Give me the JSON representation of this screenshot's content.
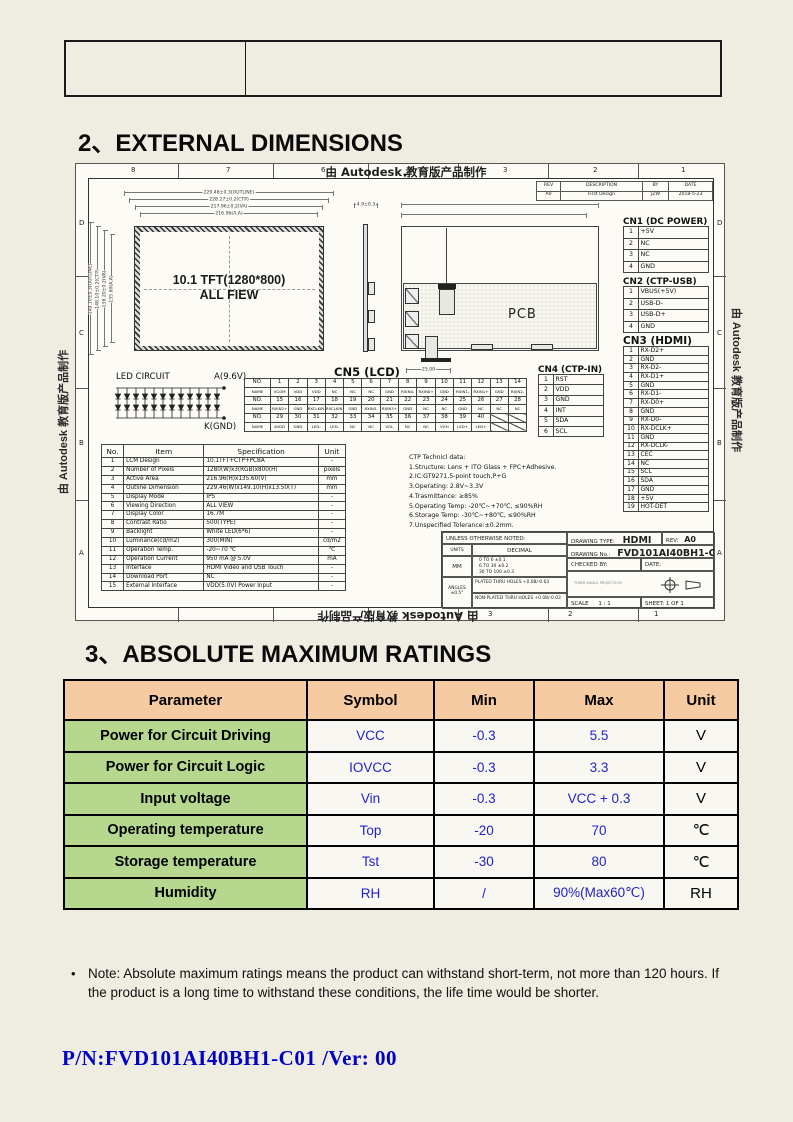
{
  "page": {
    "heading_2": "2、EXTERNAL DIMENSIONS",
    "heading_3": "3、ABSOLUTE MAXIMUM RATINGS",
    "note_bullet": "•",
    "note": "Note: Absolute maximum ratings means the product can withstand short-term, not more than 120 hours. If the product is a long time to withstand these conditions, the life time would be shorter.",
    "part_number": "P/N:FVD101AI40BH1-C01 /Ver: 00"
  },
  "drawing": {
    "watermark": "由 Autodesk 教育版产品制作",
    "watermark_arrow": "▼",
    "zones_top": [
      "8",
      "7",
      "6",
      "3",
      "2",
      "1"
    ],
    "zones_bottom": [
      "3",
      "2",
      "1"
    ],
    "zone_letters": [
      "D",
      "C",
      "B",
      "A"
    ],
    "revision": {
      "headers": [
        "REV",
        "DESCRIPTION",
        "BY",
        "DATE"
      ],
      "rows": [
        [
          "A0",
          "First Design",
          "JZW",
          "2018-5-23"
        ]
      ]
    },
    "front_view": {
      "label_line1": "10.1 TFT(1280*800)",
      "label_line2": "ALL FIEW",
      "dims_top": [
        "229.48±0.3(OUTLINE)",
        "228.27±0.2(CTP)",
        "217.96±0.2(VA)",
        "216.96(A.A)"
      ],
      "dims_left": [
        "149.10±0.3(OUTLINE)",
        "148.10±0.2(CTP)",
        "136.20±0.2(VA)",
        "135.60(A.A)"
      ],
      "dim_side": "4.9±0.3"
    },
    "rear_view": {
      "label": "PCB",
      "dim_bottom": "25.00"
    },
    "led_circuit": {
      "title": "LED CIRCUIT",
      "anode": "A(9.6V)",
      "cathode": "K(GND)"
    },
    "cn1": {
      "title": "CN1 (DC POWER)",
      "pins": [
        [
          "1",
          "+5V"
        ],
        [
          "2",
          "NC"
        ],
        [
          "3",
          "NC"
        ],
        [
          "4",
          "GND"
        ]
      ]
    },
    "cn2": {
      "title": "CN2 (CTP-USB)",
      "pins": [
        [
          "1",
          "VBUS(+5V)"
        ],
        [
          "2",
          "USB-D-"
        ],
        [
          "3",
          "USB-D+"
        ],
        [
          "4",
          "GND"
        ]
      ]
    },
    "cn3": {
      "title": "CN3 (HDMI)",
      "pins": [
        [
          "1",
          "RX-D2+"
        ],
        [
          "2",
          "GND"
        ],
        [
          "3",
          "RX-D2-"
        ],
        [
          "4",
          "RX-D1+"
        ],
        [
          "5",
          "GND"
        ],
        [
          "6",
          "RX-D1-"
        ],
        [
          "7",
          "RX-D0+"
        ],
        [
          "8",
          "GND"
        ],
        [
          "9",
          "RX-D0-"
        ],
        [
          "10",
          "RX-DCLK+"
        ],
        [
          "11",
          "GND"
        ],
        [
          "12",
          "RX-DCLK-"
        ],
        [
          "13",
          "CEC"
        ],
        [
          "14",
          "NC"
        ],
        [
          "15",
          "SCL"
        ],
        [
          "16",
          "SDA"
        ],
        [
          "17",
          "GND"
        ],
        [
          "18",
          "+5V"
        ],
        [
          "19",
          "HOT-DET"
        ]
      ]
    },
    "cn4": {
      "title": "CN4 (CTP-IN)",
      "pins": [
        [
          "1",
          "RST"
        ],
        [
          "2",
          "VDD"
        ],
        [
          "3",
          "GND"
        ],
        [
          "4",
          "INT"
        ],
        [
          "5",
          "SDA"
        ],
        [
          "6",
          "SCL"
        ]
      ]
    },
    "cn5": {
      "title": "CN5 (LCD)",
      "row_labels": [
        "NO.",
        "NAME"
      ],
      "groups": [
        {
          "no": [
            "1",
            "2",
            "3",
            "4",
            "5",
            "6",
            "7",
            "8",
            "9",
            "10",
            "11",
            "12",
            "13",
            "14"
          ],
          "name": [
            "VCOM",
            "VDD",
            "VDD",
            "NC",
            "NC",
            "NC",
            "GND",
            "RXIN0-",
            "RXIN0+",
            "GND",
            "RXIN1-",
            "RXIN1+",
            "GND",
            "RXIN2-"
          ]
        },
        {
          "no": [
            "15",
            "16",
            "17",
            "18",
            "19",
            "20",
            "21",
            "22",
            "23",
            "24",
            "25",
            "26",
            "27",
            "28"
          ],
          "name": [
            "RXIN2+",
            "GND",
            "RXCLKIN-",
            "RXCLKIN+",
            "GND",
            "RXIN3-",
            "RXIN3+",
            "GND",
            "NC",
            "NC",
            "GND",
            "NC",
            "NC",
            "NC"
          ]
        },
        {
          "no": [
            "29",
            "30",
            "31",
            "32",
            "33",
            "34",
            "35",
            "36",
            "37",
            "38",
            "39",
            "40",
            "",
            ""
          ],
          "name": [
            "AVDD",
            "GND",
            "LED-",
            "LED-",
            "NC",
            "NC",
            "VGL",
            "NC",
            "NC",
            "VGH",
            "LED+",
            "LED+",
            "",
            ""
          ]
        }
      ]
    },
    "spec_table": {
      "headers": [
        "No.",
        "Item",
        "Specification",
        "Unit"
      ],
      "rows": [
        [
          "1",
          "LCM Design",
          "10.1TFT+CTP+PCBA",
          "-"
        ],
        [
          "2",
          "Number of Pixels",
          "1280(W)x3(RGB)x800(H)",
          "pixels"
        ],
        [
          "3",
          "Active Area",
          "216.96(H)x135.60(V)",
          "mm"
        ],
        [
          "4",
          "Outline Dimension",
          "229.46(W)x149.10(H)x13.50(T)",
          "mm"
        ],
        [
          "5",
          "Display Mode",
          "IPS",
          "-"
        ],
        [
          "6",
          "Viewing Direction",
          "ALL VIEW",
          "-"
        ],
        [
          "7",
          "Display Color",
          "16.7M",
          "-"
        ],
        [
          "8",
          "Contrast Ratio",
          "500(TYPE)",
          "-"
        ],
        [
          "9",
          "Backlight",
          "White LED(6*6)",
          "-"
        ],
        [
          "10",
          "Luminance(cd/m2)",
          "300(MIN)",
          "cd/m2"
        ],
        [
          "11",
          "Operation Temp.",
          "-20~70 ℃",
          "℃"
        ],
        [
          "12",
          "Operation Current",
          "950 mA @ 5.0V",
          "mA"
        ],
        [
          "13",
          "Interface",
          "HDMI Video and USB Touch",
          "-"
        ],
        [
          "14",
          "Download Port",
          "NC",
          "-"
        ],
        [
          "15",
          "External Interface",
          "VDD(5.0V) Power Input",
          "-"
        ]
      ]
    },
    "ctp_data": [
      "CTP Technicl data:",
      "1.Structure: Lens + ITO Glass  + FPC+Adhesive.",
      "2.IC:GT9271,5-point touch,P+G",
      "3.Operating: 2.8V~3.3V",
      "4.Trasmittance: ≥85%",
      "5.Operating Temp: -20℃~+70℃, ≤90%RH",
      "6.Storage Temp: -30℃~+80℃, ≤90%RH",
      "7.Unspecified Tolerance:±0.2mm."
    ],
    "title_block": {
      "unless": "UNLESS OTHERWISE NOTED:",
      "units": "UNITS",
      "decimal": "DECIMAL",
      "mm": "MM",
      "tol_rows": [
        "0  TO    6    ±0.1",
        "6  TO   30   ±0.2",
        "30 TO  100  ±0.3"
      ],
      "angles_label": "ANGLES",
      "angles_tol": "±0.5°",
      "plated": "PLATED THRU HOLES  +0.08/-0.03",
      "non_plated": "NON-PLATED THRU HOLES  +0.08/-0.03",
      "drawing_type_label": "DRAWING TYPE:",
      "drawing_type": "HDMI",
      "rev_label": "REV:",
      "rev": "A0",
      "drawing_no_label": "DRAWING No.:",
      "drawing_no": "FVD101AI40BH1-C01",
      "checked_by_label": "CHECKED BY:",
      "date_label": "DATE:",
      "projection_note": "THIRD ANGLE PROJECTION",
      "scale_label": "SCALE",
      "scale_value": "1 : 1",
      "sheet_label": "SHEET: 1 OF 1"
    }
  },
  "ratings": {
    "headers": [
      "Parameter",
      "Symbol",
      "Min",
      "Max",
      "Unit"
    ],
    "rows": [
      {
        "parameter": "Power for Circuit Driving",
        "symbol": "VCC",
        "min": "-0.3",
        "max": "5.5",
        "unit": "V"
      },
      {
        "parameter": "Power for Circuit Logic",
        "symbol": "IOVCC",
        "min": "-0.3",
        "max": "3.3",
        "unit": "V"
      },
      {
        "parameter": "Input voltage",
        "symbol": "Vin",
        "min": "-0.3",
        "max": "VCC + 0.3",
        "unit": "V"
      },
      {
        "parameter": "Operating temperature",
        "symbol": "Top",
        "min": "-20",
        "max": "70",
        "unit": "℃"
      },
      {
        "parameter": "Storage temperature",
        "symbol": "Tst",
        "min": "-30",
        "max": "80",
        "unit": "℃"
      },
      {
        "parameter": "Humidity",
        "symbol": "RH",
        "min": "/",
        "max": "90%(Max60℃)",
        "unit": "RH"
      }
    ],
    "colors": {
      "header_bg": "#F6CBA2",
      "param_bg": "#B6D88E",
      "value_text": "#2222CC"
    }
  }
}
